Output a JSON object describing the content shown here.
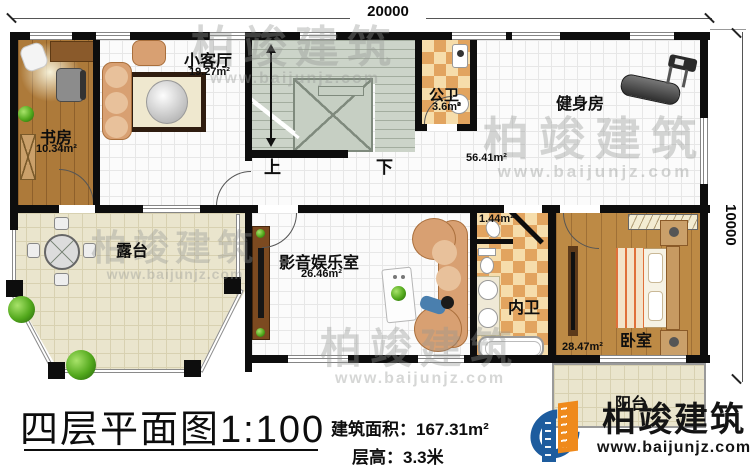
{
  "dimensions": {
    "width": "20000",
    "height": "10000"
  },
  "rooms": [
    {
      "name": "书房",
      "area": "10.34m²"
    },
    {
      "name": "小客厅",
      "area": "19.27m²"
    },
    {
      "name": "公卫",
      "area": "3.6m²"
    },
    {
      "name": "健身房",
      "area": "56.41m²"
    },
    {
      "name": "影音娱乐室",
      "area": "26.46m²"
    },
    {
      "name": "内卫",
      "area": "1.44m²"
    },
    {
      "name": "卧室",
      "area": "28.47m²"
    },
    {
      "name": "露台",
      "area": ""
    },
    {
      "name": "阳台",
      "area": ""
    }
  ],
  "stairs": {
    "up": "上",
    "down": "下"
  },
  "title": {
    "main": "四层平面图",
    "scale": "1:100"
  },
  "info": {
    "area_label": "建筑面积：",
    "area_value": "167.31m²",
    "floor_label": "层高：",
    "floor_value": "3.3米"
  },
  "logo": {
    "name": "柏竣建筑",
    "url": "www.baijunjz.com"
  },
  "watermark": {
    "name": "柏竣建筑",
    "url": "www.baijunjz.com"
  },
  "colors": {
    "wall": "#0d0d0d",
    "wood": "#b5813f",
    "tile_beige": "#eae5cd",
    "checker": "#e2a45f",
    "stairs": "#ccd4c9",
    "logo_blue": "#1d5c9e",
    "logo_orange": "#ef8a1c"
  }
}
